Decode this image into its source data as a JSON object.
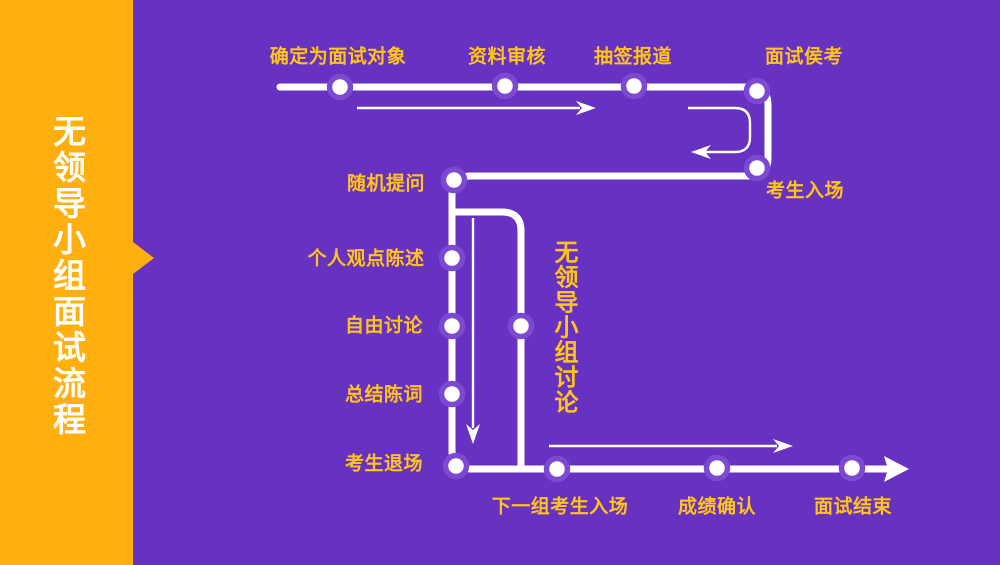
{
  "page": {
    "colors": {
      "bg": "#6731C1",
      "sidebar": "#FFB00E",
      "label": "#FFC41A",
      "ring": "#7C4AD0",
      "line": "#FFFFFF"
    }
  },
  "sidebar": {
    "title": "无领导小组面试流程"
  },
  "flow": {
    "steps": [
      {
        "id": "confirm-candidate",
        "label": "确定为面试对象"
      },
      {
        "id": "material-review",
        "label": "资料审核"
      },
      {
        "id": "draw-lots-register",
        "label": "抽签报道"
      },
      {
        "id": "interview-waiting",
        "label": "面试侯考"
      },
      {
        "id": "candidate-enter",
        "label": "考生入场"
      },
      {
        "id": "random-questions",
        "label": "随机提问"
      },
      {
        "id": "personal-statement",
        "label": "个人观点陈述"
      },
      {
        "id": "free-discussion",
        "label": "自由讨论"
      },
      {
        "id": "closing-statement",
        "label": "总结陈词"
      },
      {
        "id": "candidate-exit",
        "label": "考生退场"
      },
      {
        "id": "next-group-enter",
        "label": "下一组考生入场"
      },
      {
        "id": "score-confirm",
        "label": "成绩确认"
      },
      {
        "id": "interview-end",
        "label": "面试结束"
      }
    ],
    "group_label": "无领导小组讨论"
  }
}
